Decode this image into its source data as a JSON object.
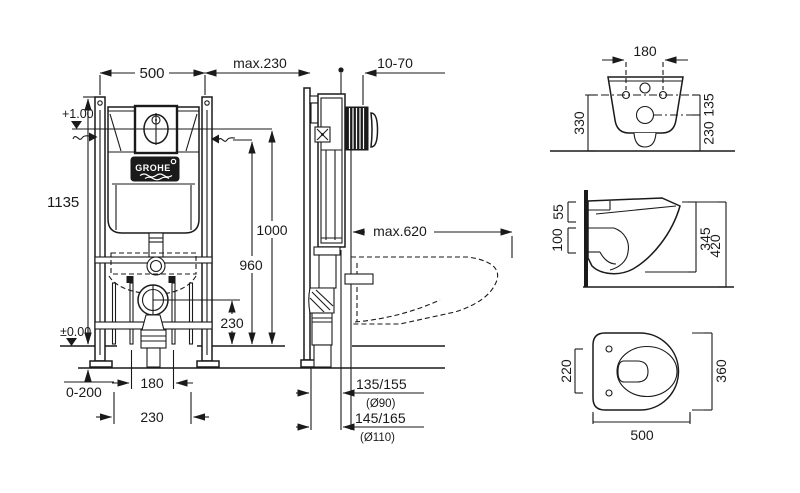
{
  "drawing": {
    "brand": "GROHE",
    "front_view": {
      "frame_width": "500",
      "frame_height": "1135",
      "actuator_level": "+1.00",
      "floor_level": "±0.00",
      "foot_adjust": "0-200",
      "rod_spacing_a": "180",
      "rod_spacing_b": "230",
      "outlet_height": "230",
      "supply_height": "960",
      "actuator_height": "1000"
    },
    "side_view": {
      "install_depth": "max.230",
      "wall_thickness": "10-70",
      "pan_depth": "max.620",
      "outlet_offset_90": "135/155",
      "outlet_dia_90": "(Ø90)",
      "outlet_offset_110": "145/165",
      "outlet_dia_110": "(Ø110)"
    },
    "pan_rear": {
      "hole_spacing": "180",
      "mount_height": "330",
      "inlet_offset": "135",
      "outlet_height": "230"
    },
    "pan_side": {
      "rim_inlet": "55",
      "rim_outlet": "100",
      "body_height": "345",
      "total_height": "420"
    },
    "pan_plan": {
      "hole_spacing": "220",
      "width": "360",
      "depth": "500"
    }
  }
}
